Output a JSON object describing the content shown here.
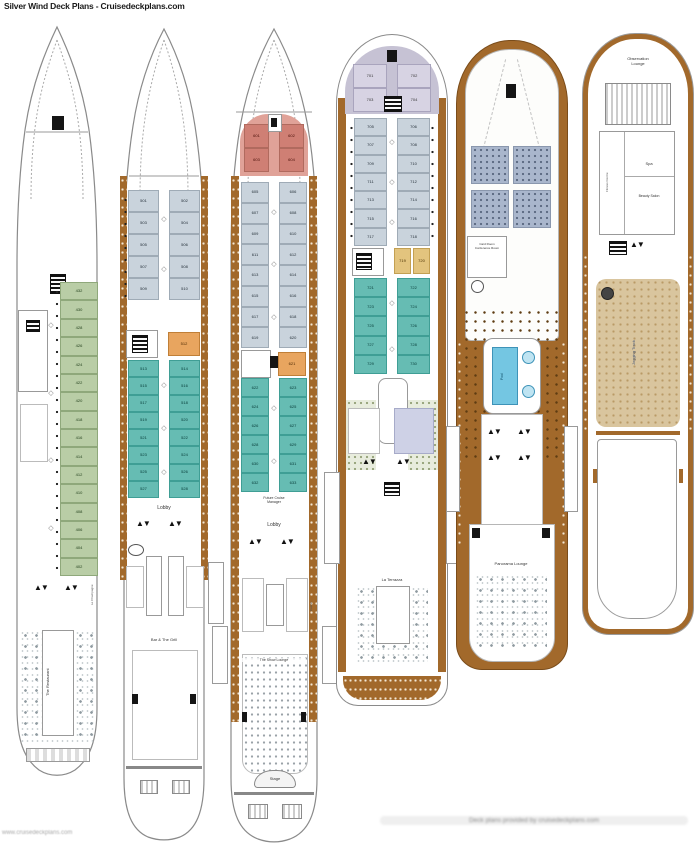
{
  "page": {
    "title": "Silver Wind Deck Plans - Cruisedeckplans.com",
    "footer_left": "www.cruisedeckplans.com",
    "footer_right": "Deck plans provided by cruisedeckplans.com"
  },
  "deck4": {
    "green_cabins": [
      "432",
      "430",
      "428",
      "426",
      "424",
      "422",
      "420",
      "418",
      "416",
      "414",
      "412",
      "410",
      "408",
      "406",
      "404",
      "402"
    ],
    "restaurant_label": "The Restaurant",
    "side_venue_label": "Le Champagne"
  },
  "deck5": {
    "gray_cabins": [
      "501",
      "502",
      "503",
      "504",
      "505",
      "506",
      "507",
      "508",
      "509",
      "510"
    ],
    "orange_cabin": "512",
    "teal_cabins": [
      "513",
      "514",
      "515",
      "516",
      "517",
      "518",
      "519",
      "520",
      "521",
      "522",
      "523",
      "524",
      "525",
      "526",
      "527",
      "528"
    ],
    "lobby_label": "Lobby",
    "venue_label": "Bar & The Grill"
  },
  "deck6": {
    "salmon_cabins": [
      "601",
      "602",
      "603",
      "604"
    ],
    "gray_cabins": [
      "605",
      "606",
      "607",
      "608",
      "609",
      "610",
      "611",
      "612",
      "613",
      "614",
      "615",
      "616",
      "617",
      "618",
      "619",
      "620"
    ],
    "orange_cabin": "621",
    "teal_cabins": [
      "622",
      "623",
      "624",
      "625",
      "626",
      "627",
      "628",
      "629",
      "630",
      "631",
      "632",
      "633"
    ],
    "office_label_1": "Future Cruise",
    "office_label_2": "Manager",
    "lobby_label": "Lobby",
    "casino_label": "Casino",
    "lounge_label": "The Show Lounge",
    "stage_label": "Stage"
  },
  "deck7": {
    "lavender_cabins": [
      "701",
      "702",
      "703",
      "704"
    ],
    "gray_cabins": [
      "705",
      "706",
      "707",
      "708",
      "709",
      "710",
      "711",
      "712",
      "713",
      "714",
      "715",
      "716",
      "717",
      "718"
    ],
    "yellow_cabins": [
      "719",
      "720"
    ],
    "teal_cabins": [
      "721",
      "722",
      "723",
      "724",
      "725",
      "726",
      "727",
      "728",
      "729",
      "730"
    ],
    "terrazza_label": "La Terrazza"
  },
  "deck8": {
    "card_room_label_1": "Card Room",
    "card_room_label_2": "Conference Room",
    "pool_label": "Pool",
    "lounge_label": "Panorama Lounge"
  },
  "deck9": {
    "observation_label_1": "Observation",
    "observation_label_2": "Lounge",
    "spa_label": "Spa",
    "salon_label": "Beauty Salon",
    "fitness_label": "Fitness Centre",
    "track_label": "Jogging Track"
  }
}
